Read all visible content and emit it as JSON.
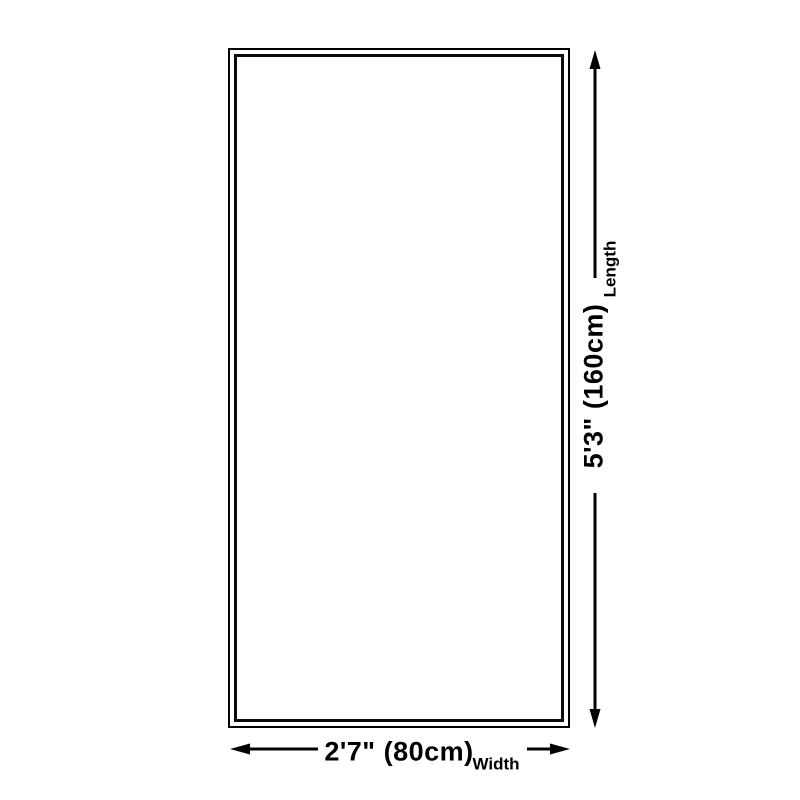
{
  "diagram": {
    "type": "product-size-diagram",
    "shape": "rectangle",
    "background_color": "#ffffff",
    "line_color": "#000000",
    "length": {
      "value": "5'3\" (160cm)",
      "label": "Length"
    },
    "width": {
      "value": "2'7\" (80cm)",
      "label": "Width"
    }
  }
}
